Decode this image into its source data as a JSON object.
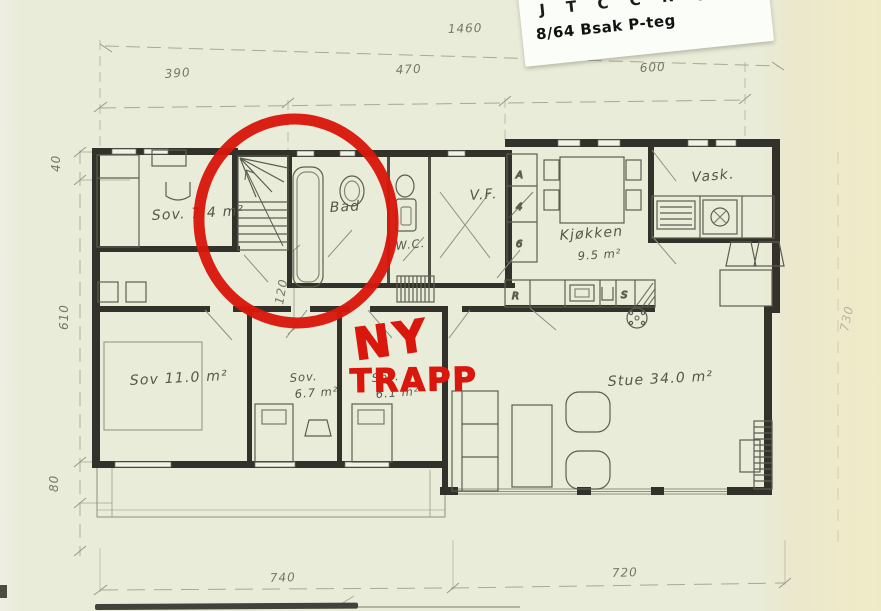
{
  "sticker": {
    "code": "J T C C R",
    "ref": "8/64 Bsak P-teg",
    "brand": "Geomatikk",
    "dots": "·····"
  },
  "annotation": {
    "word1": "NY",
    "word2": "TRAPP",
    "ink_color": "#da170d"
  },
  "dimensions": {
    "overall_width": "1460",
    "top_seg1": "390",
    "top_seg2": "470",
    "top_seg3": "600",
    "bottom_seg1": "740",
    "bottom_seg2": "720",
    "left_seg1": "40",
    "left_seg2": "610",
    "left_seg3": "80",
    "right_height": "730",
    "hall_width": "120"
  },
  "rooms": {
    "sov1": "Sov. 7.4 m²",
    "bad": "Bad",
    "wc": "W.C.",
    "vf": "V.F.",
    "kjokken_name": "Kjøkken",
    "kjokken_area": "9.5 m²",
    "vask": "Vask.",
    "sov2": "Sov 11.0 m²",
    "sov3_name": "Sov.",
    "sov3_area": "6.7 m²",
    "sov4_name": "Sov.",
    "sov4_area": "6.1 m²",
    "stue": "Stue 34.0 m²"
  },
  "cabinets": {
    "a": "A",
    "mid": "4",
    "b": "6",
    "r": "R",
    "s": "S"
  }
}
